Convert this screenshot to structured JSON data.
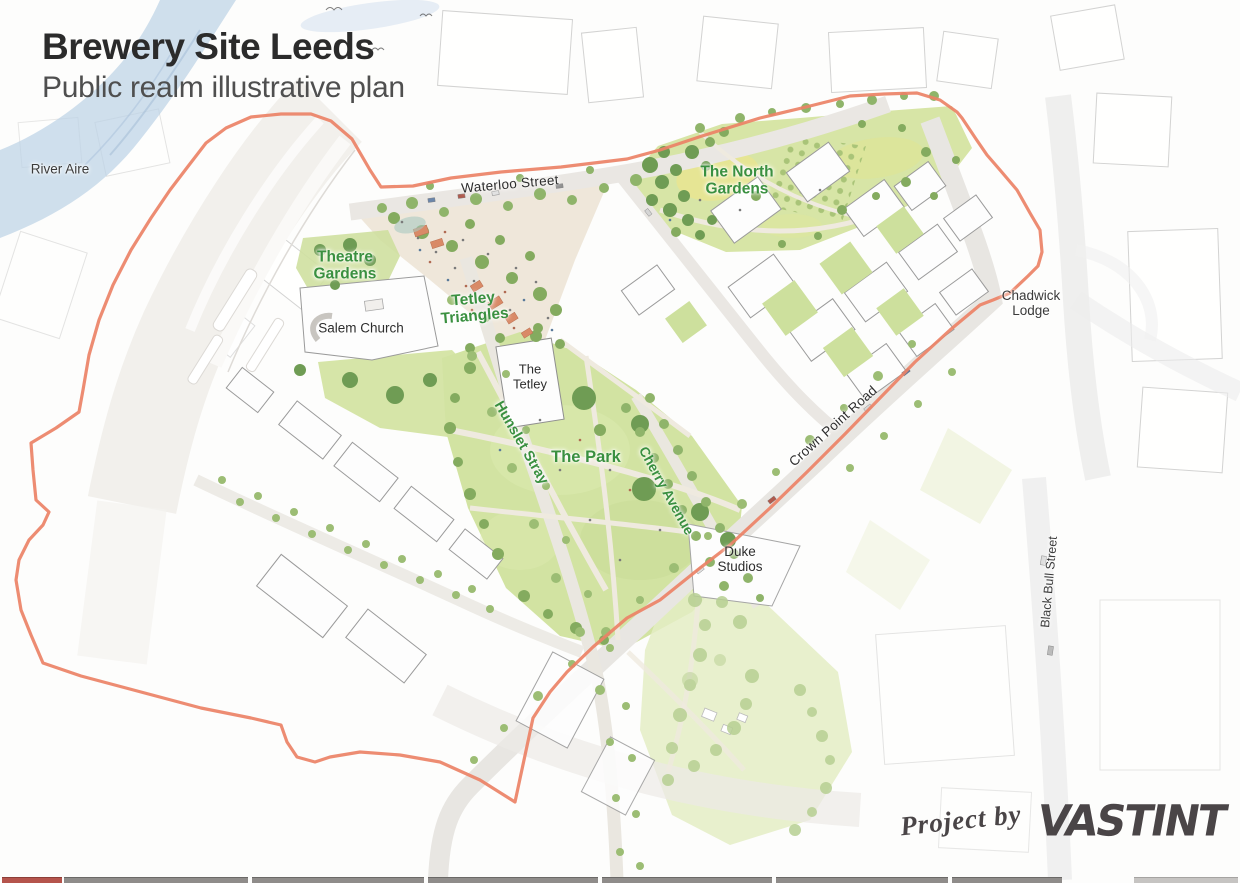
{
  "header": {
    "title": "Brewery Site Leeds",
    "subtitle": "Public realm illustrative plan"
  },
  "map_labels": {
    "river_aire": "River Aire",
    "waterloo_street": "Waterloo Street",
    "north_gardens": "The North Gardens",
    "theatre_gardens": "Theatre Gardens",
    "tetley_triangles": "Tetley Triangles",
    "salem_church": "Salem Church",
    "the_tetley": "The Tetley",
    "hunslet_stray": "Hunslet Stray",
    "the_park": "The Park",
    "cherry_avenue": "Cherry Avenue",
    "crown_point_road": "Crown Point Road",
    "chadwick_lodge": "Chadwick Lodge",
    "duke_studios": "Duke Studios",
    "black_bull_street": "Black Bull Street"
  },
  "footer": {
    "credit_prefix": "Project by",
    "brand": "VASTINT"
  },
  "colors": {
    "site_boundary": "#EB8266",
    "green_label": "#3A9040",
    "park_green": "#D3E3A3",
    "river_blue": "#BCD2E6",
    "title_text": "#2B2B2B",
    "brand_gray": "#4A4547"
  }
}
